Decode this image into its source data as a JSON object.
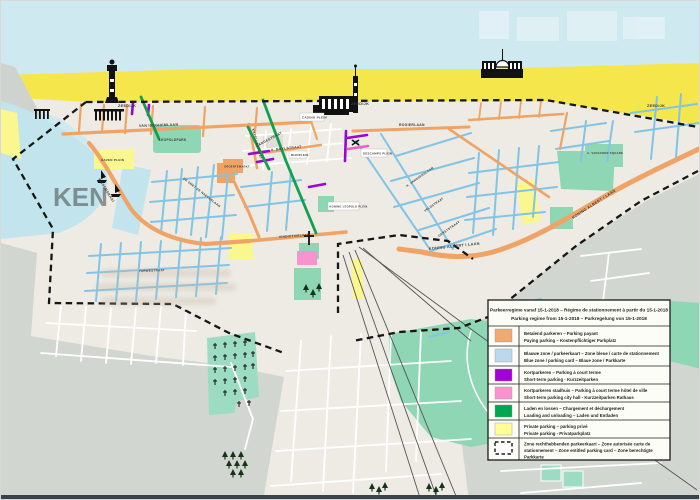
{
  "legend": {
    "title_line1": "Parkeerregime vanaf 15-1-2018 – Régime de stationnement à partir du 15-1-2018",
    "title_line2": "Parking regime from 15-1-2018 – Parkregelung von 15-1-2018",
    "items": [
      {
        "key": "paying-parking",
        "color": "#f0a96e",
        "line1": "Betalend parkeren – Parking payant",
        "line2": "Paying parking – Kostenpflichtiger Parkplatz"
      },
      {
        "key": "blue-zone",
        "color": "#bdd7ee",
        "line1": "Blauwe zone / parkeerkaart – Zone bleue / carte de stationnement",
        "line2": "Blue zone / parking card – Blaue zone / Parkkarte"
      },
      {
        "key": "short-term-parking",
        "color": "#a300d6",
        "line1": "Kortparkeren – Parking à court terme",
        "line2": "Short-term parking - Kurzzeitparken"
      },
      {
        "key": "short-term-city-hall",
        "color": "#f893cf",
        "line1": "Kortparkeren stadhuis – Parking à court terme hôtel de ville",
        "line2": "Short-term parking city hall - Kurzzeitparken Rathaus"
      },
      {
        "key": "loading-unloading",
        "color": "#00a651",
        "line1": "Laden en lossen – Chargement et déchargement",
        "line2": "Loading and unloading – Laden und Entladen"
      },
      {
        "key": "private-parking",
        "color": "#ffff96",
        "line1": "Private parking – parking privé",
        "line2": "Private parking - Privatparkplatz"
      },
      {
        "key": "entitled-zone",
        "swatch_style": "dashed-outline",
        "line1": "Zone rechthebbenden parkeerkaart – Zone autorisée carte de",
        "line2": "stationnement – Zone entitled parking card – Zone berechtigte",
        "line3": "Parkkarte"
      }
    ]
  },
  "map": {
    "street_labels": {
      "zeedijk": "ZEEDIJK",
      "van_iseghemlaan": "VAN ISEGHEMLAAN",
      "visserskaai": "VISSERSKAAI",
      "langestraat": "LANGESTRAAT",
      "kapellestraat": "KAPELLESTRAAT",
      "a_buylstraat": "A. BUYLSTRAAT",
      "rogierlaan": "ROGIERLAAN",
      "koning_albert_laan": "KONING ALBERT I LAAN",
      "vindictivelaan": "VINDICTIVELAAN",
      "de_smet_de_naeyerlaan": "DE SMET DE NAEYERLAAN",
      "gerststraat": "GERSTSTRAAT",
      "veldstraat": "VELDSTRAAT",
      "k_janssenslaan": "K. JANSSENSLAAN",
      "tarwestraat": "TARWESTRAAT"
    },
    "place_labels": {
      "leopoldpark": "LEOPOLDPARK",
      "haven_plein": "HAVEN PLEIN",
      "casino_plein": "CASINO PLEIN",
      "groentemarkt": "GROENTEMARKT",
      "mijnplein": "MIJNPLEIN",
      "koning_leopold_plein": "KONING LEOPOLD PLEIN",
      "descamps_plein": "DESCAMPS PLEIN",
      "a_vanacker_square": "A. VANACKER SQUARE"
    },
    "watermark_text": "KEN",
    "icons": [
      "lighthouse-icon",
      "harbor-pier-icon",
      "sailboat-icon",
      "casino-building-icon",
      "beach-pavilion-icon",
      "church-cross-icon",
      "cemetery-cross-icon",
      "tree-icon",
      "monument-icon"
    ],
    "colors": {
      "sea": "#cfe9f1",
      "beach": "#f5e74b",
      "land": "#edebe4",
      "outside_zone_gray": "#d2d6d0",
      "harbor_water": "#c2e4ec",
      "park_green": "#8fd6b5",
      "cemetery_green": "#9cdcc2",
      "street_orange": "#efa466",
      "street_blue": "#82c4e6",
      "street_purple": "#9b05cf",
      "street_pink": "#ee5fc4",
      "street_green": "#11a04f",
      "private_yellow": "#fbf78f",
      "zone_boundary": "#161616",
      "railway": "#555555"
    }
  }
}
